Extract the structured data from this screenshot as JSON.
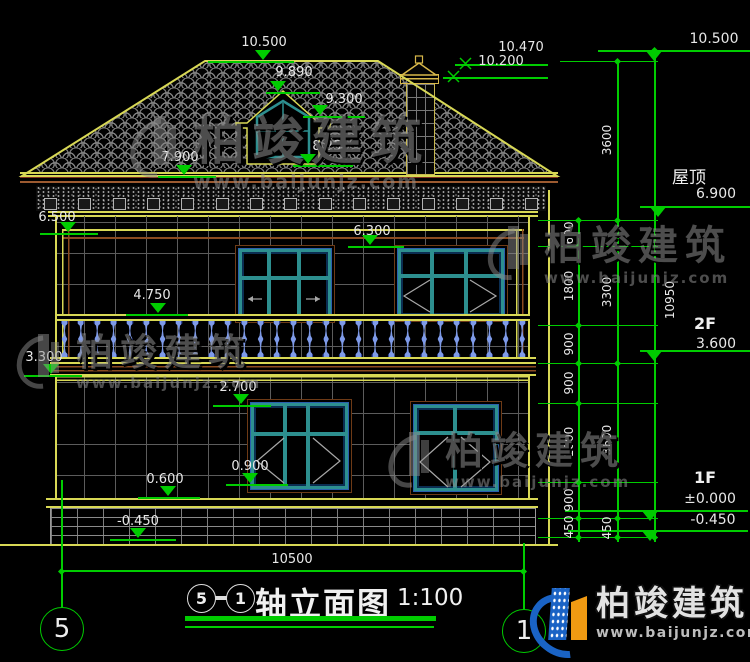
{
  "drawing": {
    "title": "轴立面图",
    "scale": "1:100",
    "title_axis_left": "5",
    "title_axis_right": "1",
    "axis_bubble_left": "5",
    "axis_bubble_right": "1"
  },
  "marks": {
    "m10_500": "10.500",
    "m9_890": "9.890",
    "m9_300": "9.300",
    "m8_250": "8.250",
    "m7_900": "7.900",
    "m10_470": "10.470",
    "m10_200": "10.200",
    "m6_500": "6.500",
    "m6_300": "6.300",
    "m4_750": "4.750",
    "m3_300": "3.300",
    "m2_700": "2.700",
    "m0_900": "0.900",
    "m0_600": "0.600",
    "m_neg0_450": "-0.450"
  },
  "right_levels": {
    "top": "10.500",
    "roof_label": "屋顶",
    "roof_value": "6.900",
    "f2_label": "2F",
    "f2_value": "3.600",
    "f1_label": "1F",
    "f1_value": "±0.000",
    "ground_value": "-0.450"
  },
  "dims": {
    "chain_inner": [
      "600",
      "1800",
      "900",
      "900",
      "1800",
      "900",
      "450"
    ],
    "chain_outer": [
      "3600",
      "3300",
      "3600",
      "450"
    ],
    "overall_height": "10950",
    "overall_width": "10500"
  },
  "watermark": {
    "name": "柏竣建筑",
    "url": "www.baijunjz.com"
  },
  "brand": {
    "name": "柏竣建筑",
    "url": "www.baijunjz.com"
  },
  "colors": {
    "dim_green": "#00cc00",
    "line_yellow": "#d8d855",
    "window_teal": "#2d8f8f",
    "baluster_blue": "#7e9ae8",
    "brand_blue": "#1a63c5",
    "brand_orange": "#f09a12"
  },
  "counts": {
    "balusters": 29,
    "corbels": 15
  }
}
